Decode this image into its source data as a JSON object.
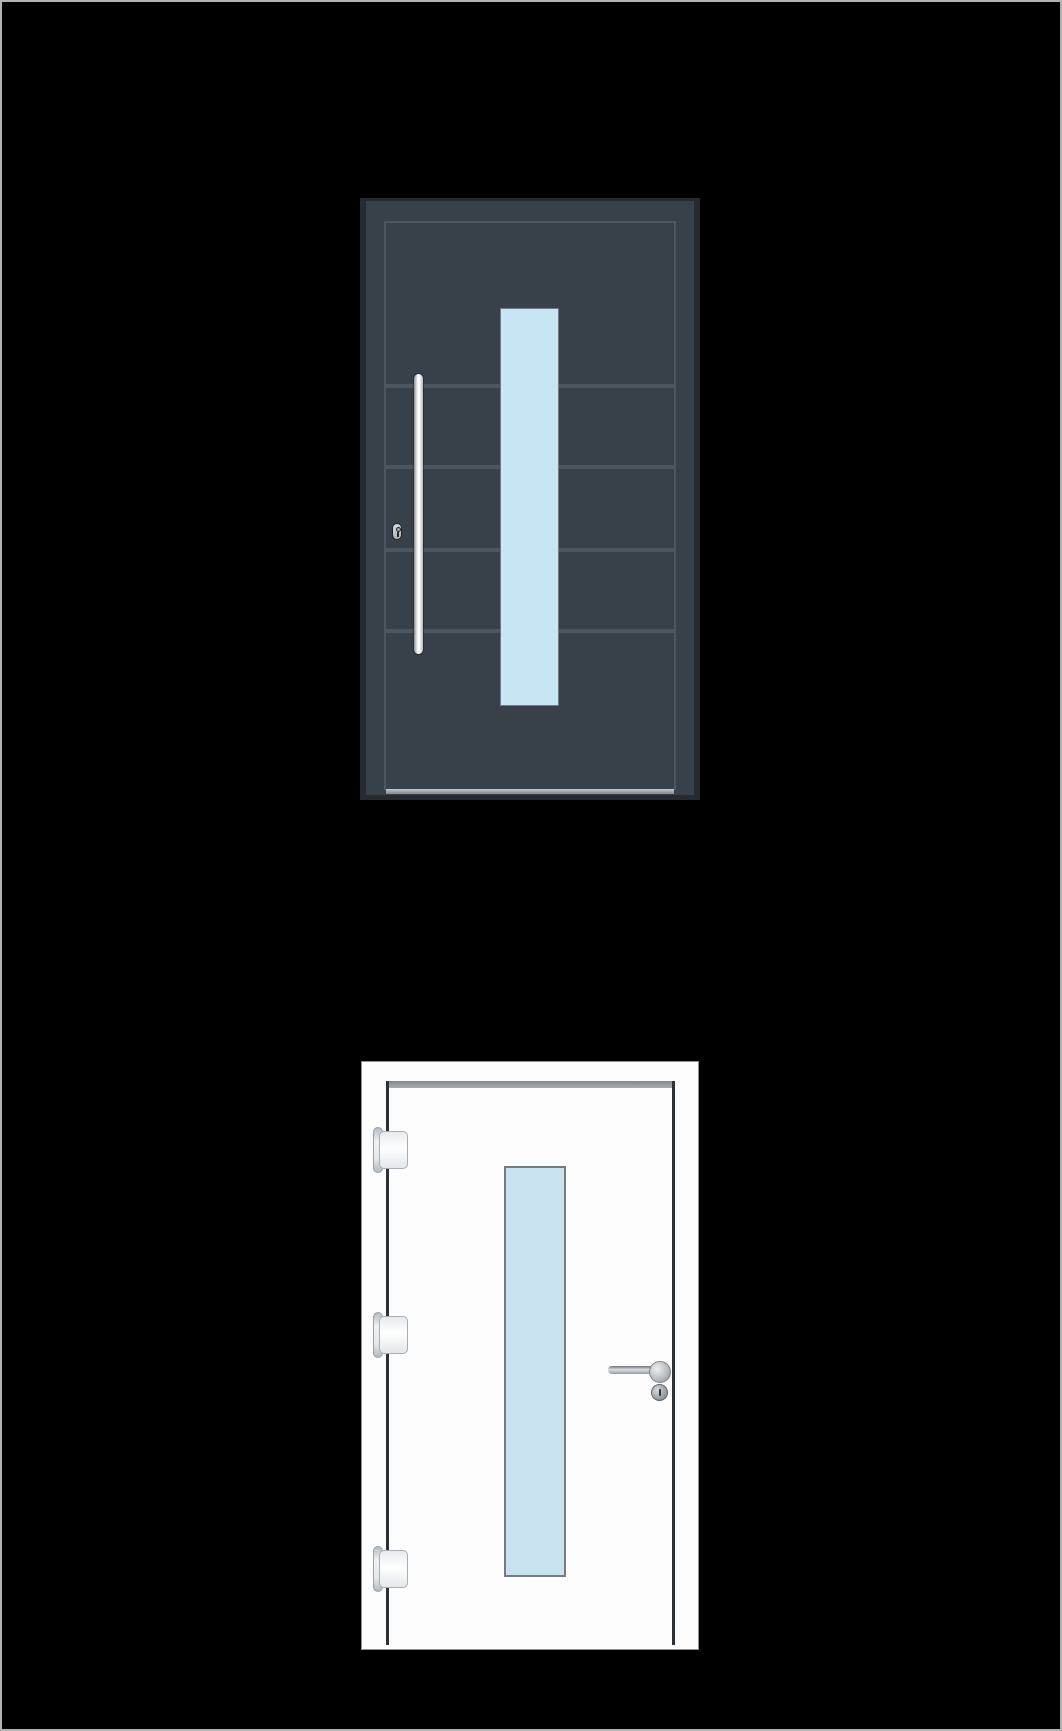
{
  "canvas": {
    "background_color": "#000000",
    "border_color": "#b2b2b2"
  },
  "previews": {
    "exterior": {
      "title": "entrance-door-exterior-view",
      "door_color_hex": "#38404a",
      "door_color_name": "anthracite",
      "glazing_color_hex": "#c7e5f2",
      "groove_count": 4,
      "features": [
        "vertical-bar-handle",
        "lock-cylinder",
        "vertical-glazing-strip",
        "horizontal-grooves",
        "threshold-sill"
      ]
    },
    "interior": {
      "title": "entrance-door-interior-view",
      "door_color_hex": "#fdfdfd",
      "door_color_name": "white",
      "glazing_color_hex": "#c8e3ef",
      "hinge_count": 3,
      "features": [
        "hinges",
        "lever-handle",
        "privacy-knob",
        "vertical-glazing-strip"
      ]
    }
  }
}
